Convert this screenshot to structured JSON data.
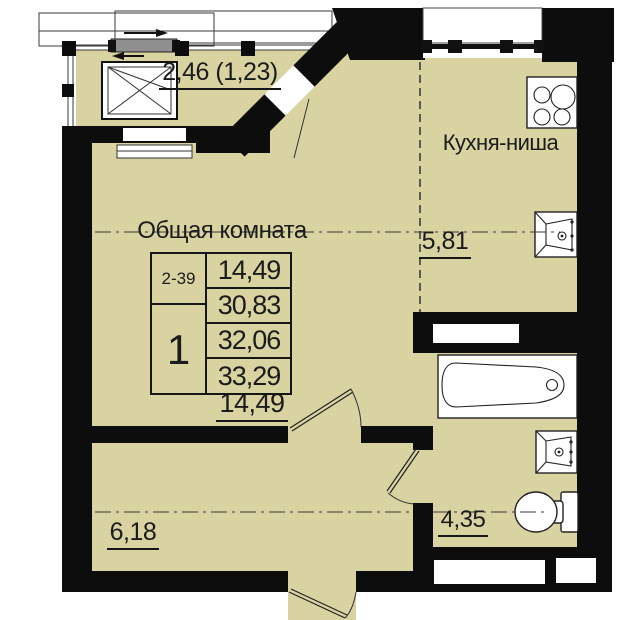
{
  "plan": {
    "title_labels": {
      "balcony_area": "2,46 (1,23)",
      "kitchen_name": "Кухня-ниша",
      "kitchen_area": "5,81",
      "room_name": "Общая комната",
      "room_area": "14,49",
      "hall_area": "6,18",
      "bath_area": "4,35"
    },
    "info_table": {
      "apartment_range": "2-39",
      "rooms_count": "1",
      "areas": [
        "14,49",
        "30,83",
        "32,06",
        "33,29"
      ]
    },
    "fixtures": [
      "stove-icon",
      "kitchen-sink-icon",
      "bathtub-icon",
      "wash-sink-icon",
      "toilet-icon",
      "sliding-window-icon",
      "window-cross-icon"
    ],
    "colors": {
      "floor": "#d9d3a2",
      "wall": "#0d0d0d",
      "line": "#3a3a3a"
    }
  }
}
